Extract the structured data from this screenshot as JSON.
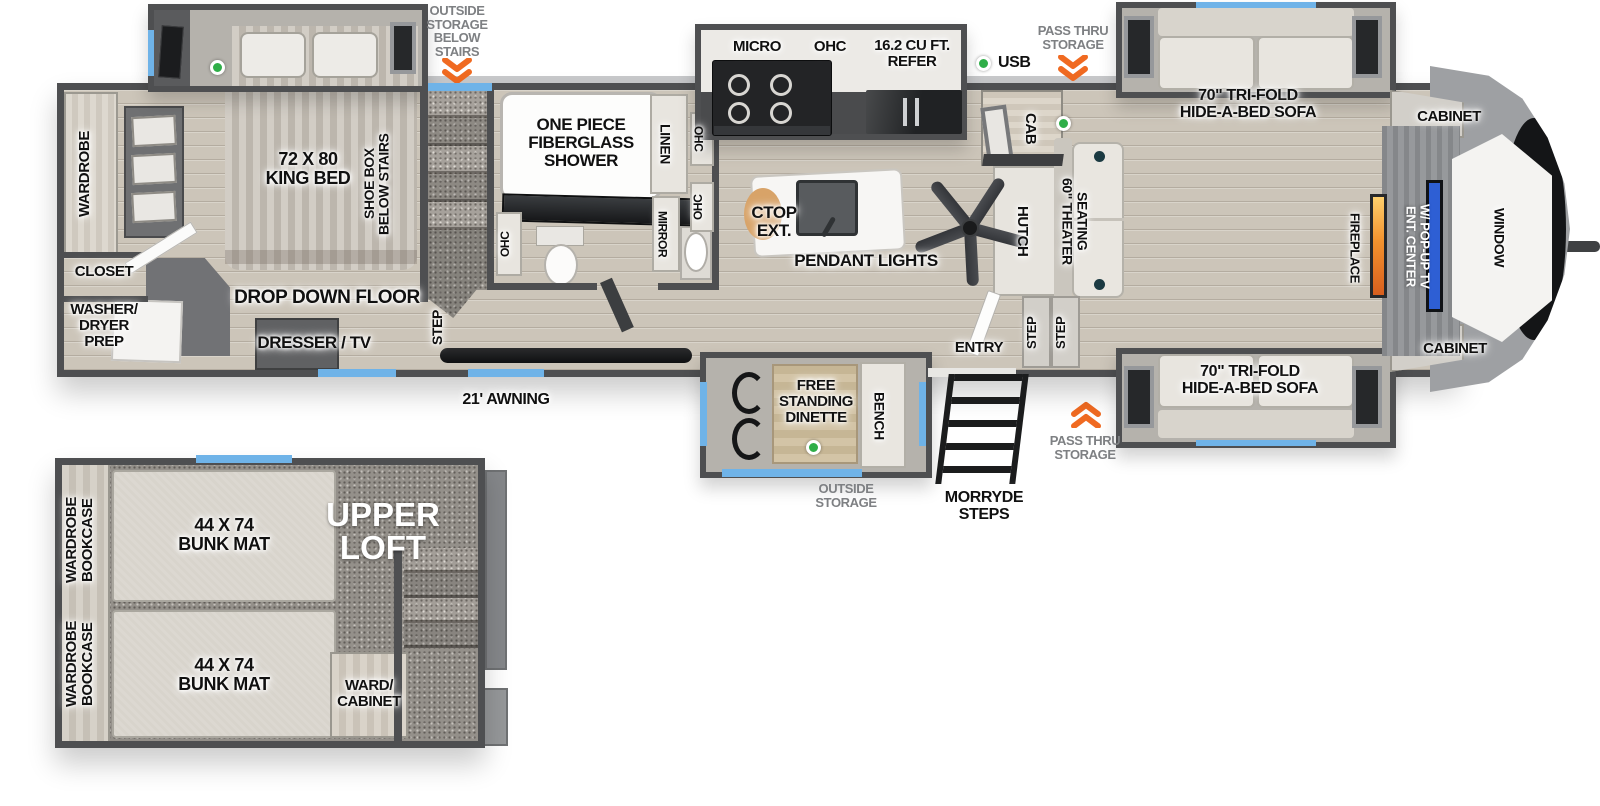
{
  "colors": {
    "wall": "#4e4f51",
    "window_accent": "#6fb3e8",
    "storage_arrow": "#f06a21",
    "indicator_green": "#2fae48",
    "fireplace_orange": "#f2922e",
    "tv_blue": "#2e5fd4"
  },
  "exterior": {
    "outside_storage_below_stairs": "OUTSIDE\nSTORAGE\nBELOW\nSTAIRS",
    "usb_label": "USB",
    "pass_thru_storage_top": "PASS THRU\nSTORAGE",
    "pass_thru_storage_bottom": "PASS THRU\nSTORAGE",
    "morryde_steps": "MORRYDE\nSTEPS",
    "outside_storage": "OUTSIDE\nSTORAGE",
    "awning": "21' AWNING"
  },
  "bedroom": {
    "wardrobe": "WARDROBE",
    "closet": "CLOSET",
    "washer_dryer": "WASHER/\nDRYER\nPREP",
    "king_bed": "72 X 80\nKING BED",
    "shoe_box": "SHOE BOX\nBELOW STAIRS",
    "drop_down_floor": "DROP DOWN FLOOR",
    "dresser_tv": "DRESSER / TV",
    "step": "STEP"
  },
  "bathroom": {
    "shower": "ONE PIECE\nFIBERGLASS\nSHOWER",
    "linen": "LINEN",
    "ohc_top": "OHC",
    "ohc_mid": "OHC",
    "ohc_toilet": "OHC",
    "mirror": "MIRROR"
  },
  "kitchen": {
    "micro": "MICRO",
    "ohc": "OHC",
    "refer": "16.2 CU FT.\nREFER",
    "ctop_ext": "CTOP\nEXT.",
    "pendant_lights": "PENDANT LIGHTS",
    "cab": "CAB",
    "hutch": "HUTCH"
  },
  "living": {
    "theater_seating": "60\" THEATER\nSEATING",
    "sofa_top": "70\" TRI-FOLD\nHIDE-A-BED SOFA",
    "sofa_bottom": "70\" TRI-FOLD\nHIDE-A-BED SOFA",
    "cabinet_top": "CABINET",
    "cabinet_bottom": "CABINET",
    "fireplace": "FIREPLACE",
    "ent_center": "ENT. CENTER\nW/ POP-UP TV",
    "window": "WINDOW",
    "entry": "ENTRY",
    "step_left": "STEP",
    "step_right": "STEP"
  },
  "dinette": {
    "free_standing_dinette": "FREE\nSTANDING\nDINETTE",
    "bench": "BENCH"
  },
  "loft": {
    "title": "UPPER\nLOFT",
    "wardrobe_bookcase_top": "WARDROBE\nBOOKCASE",
    "wardrobe_bookcase_bottom": "WARDROBE\nBOOKCASE",
    "bunk_top": "44 X 74\nBUNK MAT",
    "bunk_bottom": "44 X 74\nBUNK MAT",
    "ward_cabinet": "WARD/\nCABINET"
  }
}
